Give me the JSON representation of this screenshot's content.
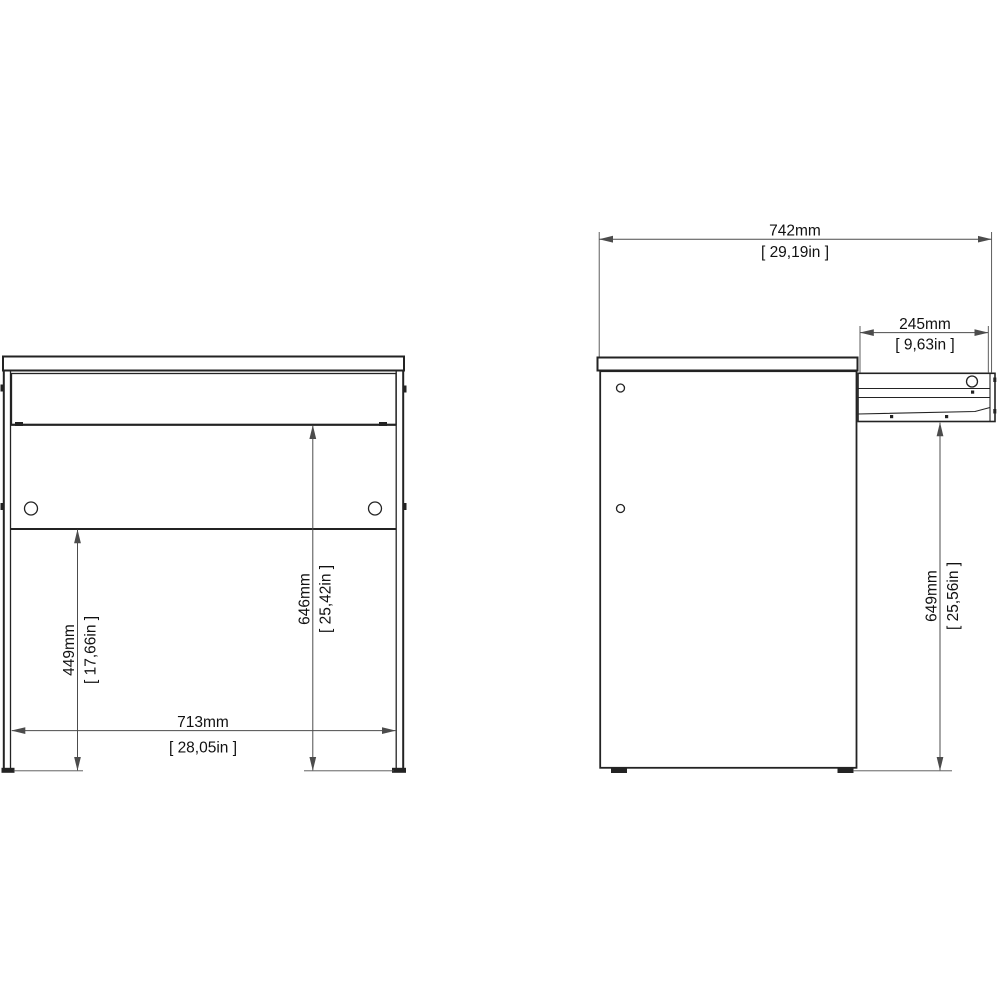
{
  "drawing_title": "desk-dimension-drawing",
  "colors": {
    "background": "#ffffff",
    "part-line": "#232323",
    "dim-line": "#4c4c4c",
    "text": "#111111"
  },
  "front_view": {
    "inner_width": {
      "mm": "713mm",
      "inch": "[ 28,05in ]"
    },
    "floor_to_shelf": {
      "mm": "449mm",
      "inch": "[ 17,66in ]"
    },
    "floor_to_drawer": {
      "mm": "646mm",
      "inch": "[ 25,42in ]"
    }
  },
  "side_view": {
    "total_depth": {
      "mm": "742mm",
      "inch": "[ 29,19in ]"
    },
    "drawer_depth": {
      "mm": "245mm",
      "inch": "[ 9,63in ]"
    },
    "floor_to_underside": {
      "mm": "649mm",
      "inch": "[ 25,56in ]"
    }
  }
}
